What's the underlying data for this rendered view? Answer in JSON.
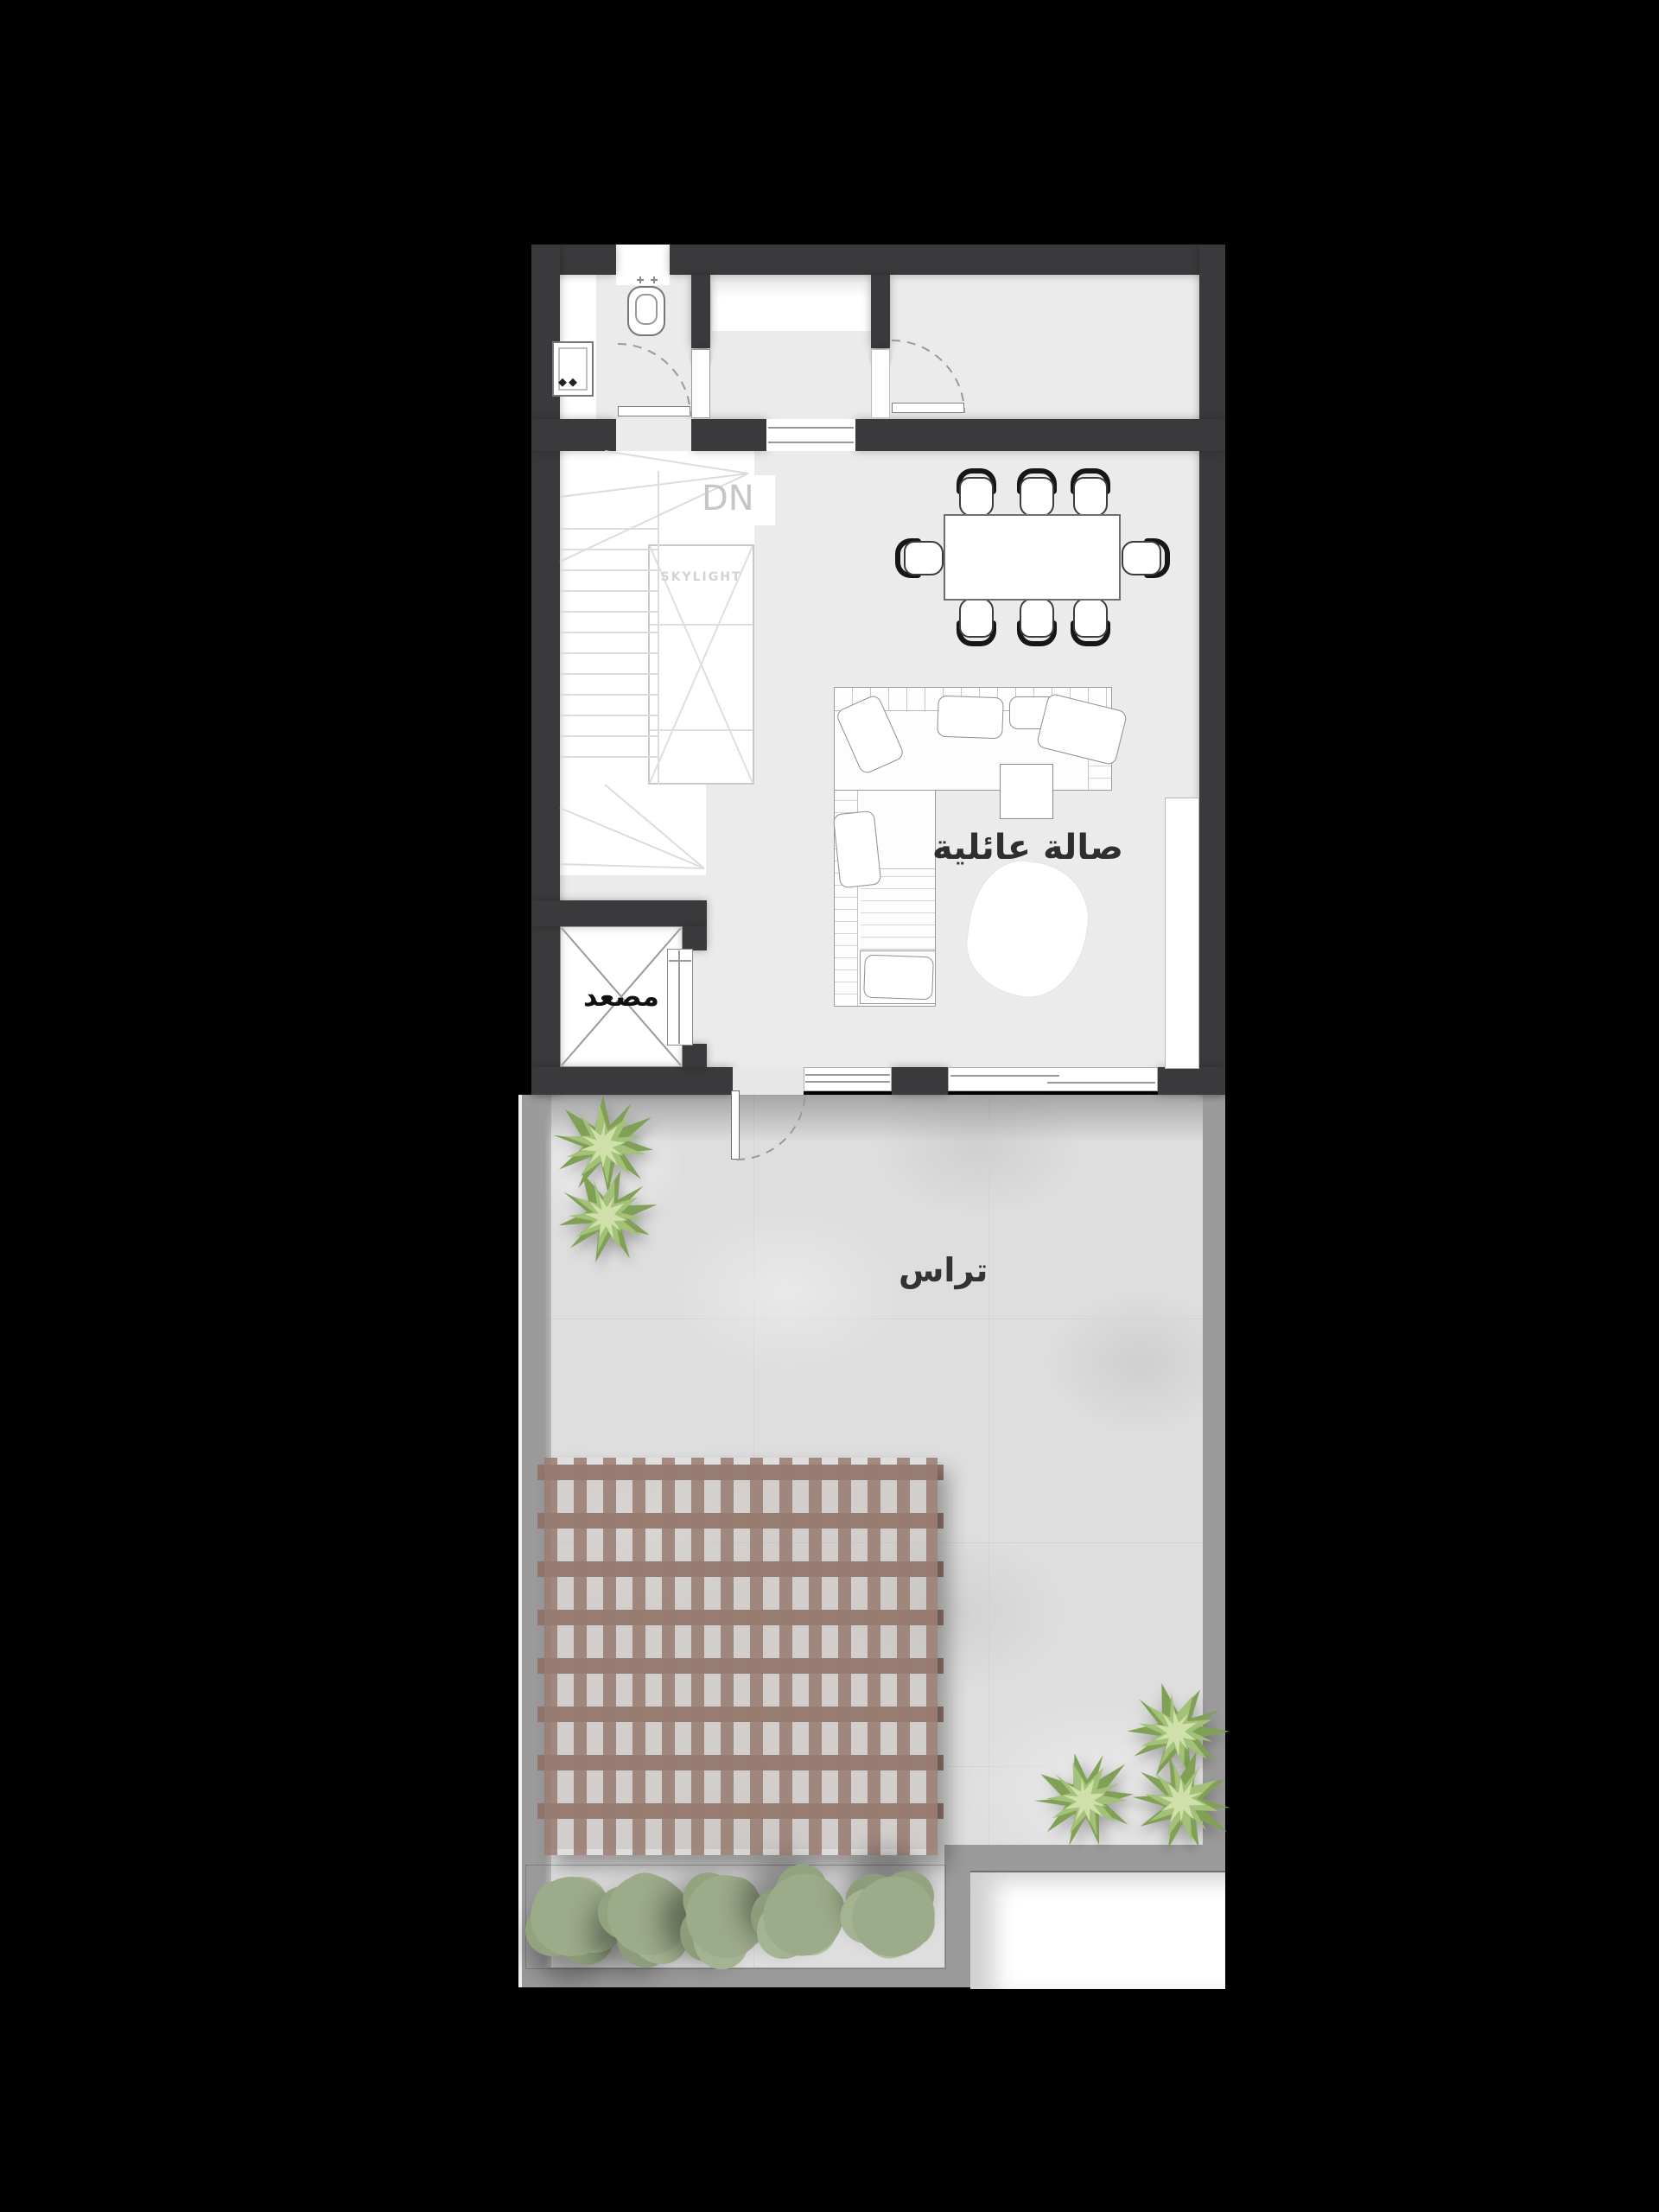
{
  "title": "Residential floor plan – family hall level with roof terrace",
  "labels": {
    "dn": "DN",
    "skylight": "SKYLIGHT",
    "elevator": "مصعد",
    "family_hall": "صالة عائلية",
    "terrace": "تراس"
  },
  "rooms": [
    {
      "name": "family-hall",
      "label": "صالة عائلية"
    },
    {
      "name": "terrace",
      "label": "تراس"
    },
    {
      "name": "elevator",
      "label": "مصعد"
    },
    {
      "name": "staircase",
      "label": "DN"
    },
    {
      "name": "skylight-shaft",
      "label": "SKYLIGHT"
    },
    {
      "name": "bathroom",
      "label": ""
    },
    {
      "name": "dining-area",
      "label": ""
    }
  ],
  "furniture": {
    "dining_chairs": 8,
    "dining_table": 1,
    "sofa": "L-shaped sectional with cushions",
    "coffee_table": 1,
    "rug": 1,
    "tv_console": 1,
    "toilet": 1,
    "vanity_cabinet": 1,
    "terrace_shrubs": 5,
    "terrace_plants": 5,
    "pergola": 1
  },
  "colors": {
    "background": "#000000",
    "wall": "#3a3a3c",
    "indoor_floor": "#ebebec",
    "stair_white": "#ffffff",
    "terrace_stone": "#dedede",
    "terrace_border": "#9b9b9b",
    "pergola_wood": "#97796e",
    "plant_green": "#7fa055",
    "hedge_green": "#9cab8a",
    "label_dark": "#2f2f2f",
    "label_light": "#c6c6c6"
  }
}
